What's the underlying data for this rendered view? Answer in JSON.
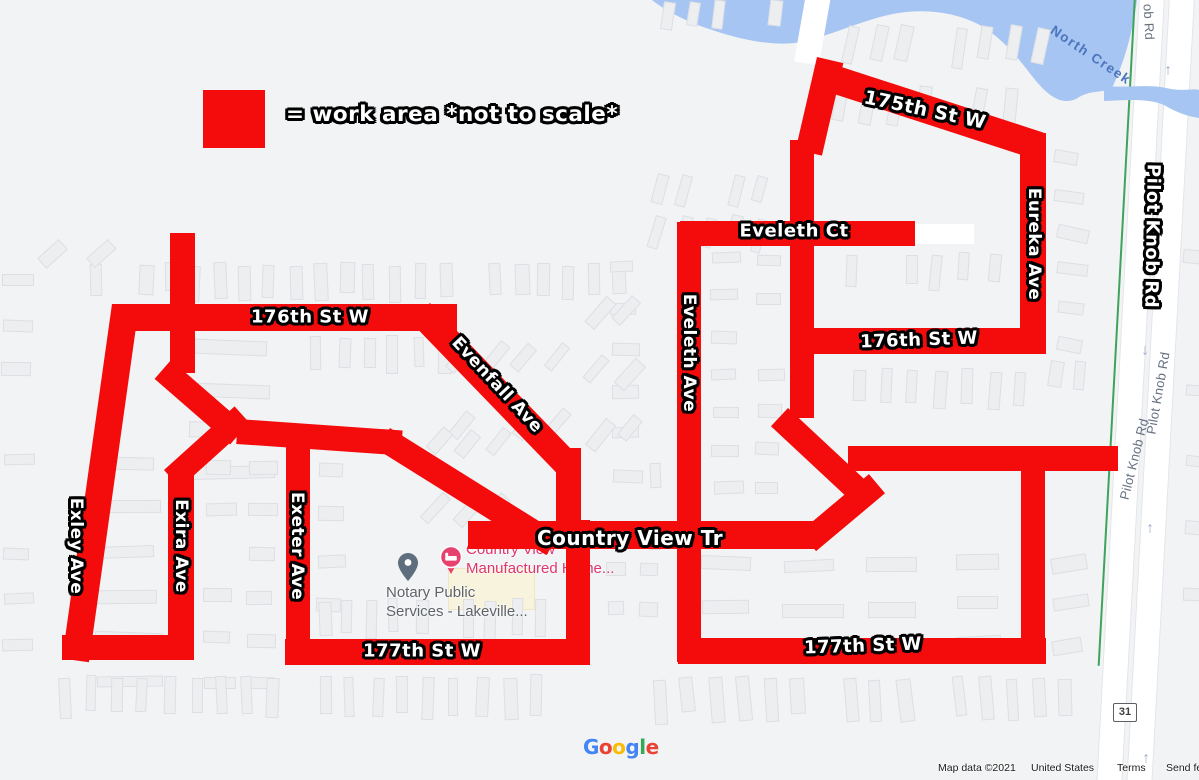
{
  "legend": {
    "swatch_color": "#f40b0b",
    "text": "= work area *not to scale*"
  },
  "colors": {
    "work_area_red": "#f40b0b",
    "map_background": "#f1f3f4",
    "water": "#a6c5f2",
    "water_label": "#4c74bd",
    "bike_route_green": "#3ea45b",
    "road_white": "#ffffff",
    "gray_road_label": "#667080",
    "poi_lodging_pink": "#e8416f",
    "poi_generic_gray": "#5f6b79",
    "arrow_blue_gray": "#9aa6c9"
  },
  "street_labels": [
    {
      "id": "175th-st-w",
      "text": "175th St W",
      "x": 925,
      "y": 110,
      "rot": 12,
      "size": 19
    },
    {
      "id": "eveleth-ct",
      "text": "Eveleth Ct",
      "x": 794,
      "y": 231,
      "rot": 0,
      "size": 18
    },
    {
      "id": "eveleth-ave",
      "text": "Eveleth Ave",
      "x": 689,
      "y": 353,
      "rot": 90,
      "size": 17
    },
    {
      "id": "176th-st-w-left",
      "text": "176th St W",
      "x": 310,
      "y": 317,
      "rot": 0,
      "size": 18
    },
    {
      "id": "evenfall-ave",
      "text": "Evenfall Ave",
      "x": 497,
      "y": 385,
      "rot": 47,
      "size": 17
    },
    {
      "id": "176th-st-w-right",
      "text": "176th St W",
      "x": 919,
      "y": 340,
      "rot": -2,
      "size": 18
    },
    {
      "id": "eureka-ave",
      "text": "Eureka Ave",
      "x": 1034,
      "y": 244,
      "rot": 90,
      "size": 17
    },
    {
      "id": "pilot-knob-rd",
      "text": "Pilot Knob Rd",
      "x": 1152,
      "y": 236,
      "rot": 91,
      "size": 18
    },
    {
      "id": "country-view-tr",
      "text": "Country View Tr",
      "x": 630,
      "y": 538,
      "rot": 0,
      "size": 20
    },
    {
      "id": "exley-ave",
      "text": "Exley Ave",
      "x": 76,
      "y": 546,
      "rot": 90,
      "size": 17
    },
    {
      "id": "exira-ave",
      "text": "Exira Ave",
      "x": 181,
      "y": 546,
      "rot": 90,
      "size": 17
    },
    {
      "id": "exeter-ave",
      "text": "Exeter Ave",
      "x": 297,
      "y": 546,
      "rot": 90,
      "size": 17
    },
    {
      "id": "177th-st-w-left",
      "text": "177th St W",
      "x": 422,
      "y": 651,
      "rot": 0,
      "size": 18
    },
    {
      "id": "177th-st-w-right",
      "text": "177th St W",
      "x": 863,
      "y": 646,
      "rot": -2,
      "size": 18
    }
  ],
  "gray_road_labels": [
    {
      "text": "Pilot Knob Rd",
      "x": 1158,
      "y": 393,
      "rot": -80
    },
    {
      "text": "Pilot Knob Rd",
      "x": 1134,
      "y": 459,
      "rot": -76
    },
    {
      "text": "ob Rd",
      "x": 1149,
      "y": 22,
      "rot": 87
    }
  ],
  "water": {
    "label": "North Creek",
    "label_x": 1091,
    "label_y": 55,
    "label_rot": 34
  },
  "work_area_segments": [
    {
      "x": 112,
      "y": 304,
      "w": 345,
      "h": 27,
      "rot": 0
    },
    {
      "x": 170,
      "y": 233,
      "w": 25,
      "h": 140,
      "rot": 0
    },
    {
      "x": 171,
      "y": 360,
      "w": 100,
      "h": 25,
      "rot": 41
    },
    {
      "x": 238,
      "y": 419,
      "w": 165,
      "h": 25,
      "rot": 4
    },
    {
      "x": 390,
      "y": 428,
      "w": 200,
      "h": 25,
      "rot": 32
    },
    {
      "x": 430,
      "y": 303,
      "w": 215,
      "h": 27,
      "rot": 46
    },
    {
      "x": 556,
      "y": 448,
      "w": 25,
      "h": 100,
      "rot": 0
    },
    {
      "x": 566,
      "y": 520,
      "w": 24,
      "h": 145,
      "rot": 0
    },
    {
      "x": 468,
      "y": 521,
      "w": 347,
      "h": 28,
      "rot": 0
    },
    {
      "x": 285,
      "y": 639,
      "w": 305,
      "h": 26,
      "rot": 0
    },
    {
      "x": 286,
      "y": 438,
      "w": 24,
      "h": 227,
      "rot": 0
    },
    {
      "x": 112,
      "y": 304,
      "w": 27,
      "h": 358,
      "rot": 8
    },
    {
      "x": 62,
      "y": 635,
      "w": 132,
      "h": 25,
      "rot": 0
    },
    {
      "x": 168,
      "y": 468,
      "w": 26,
      "h": 192,
      "rot": 0
    },
    {
      "x": 164,
      "y": 470,
      "w": 95,
      "h": 24,
      "rot": -42
    },
    {
      "x": 817,
      "y": 57,
      "w": 27,
      "h": 95,
      "rot": 13
    },
    {
      "x": 820,
      "y": 60,
      "w": 235,
      "h": 28,
      "rot": 18
    },
    {
      "x": 1020,
      "y": 133,
      "w": 26,
      "h": 221,
      "rot": 0
    },
    {
      "x": 790,
      "y": 140,
      "w": 24,
      "h": 278,
      "rot": 0
    },
    {
      "x": 788,
      "y": 408,
      "w": 105,
      "h": 25,
      "rot": 43
    },
    {
      "x": 800,
      "y": 532,
      "w": 90,
      "h": 25,
      "rot": -40
    },
    {
      "x": 848,
      "y": 446,
      "w": 270,
      "h": 25,
      "rot": 0
    },
    {
      "x": 1021,
      "y": 455,
      "w": 24,
      "h": 205,
      "rot": 0
    },
    {
      "x": 678,
      "y": 638,
      "w": 368,
      "h": 26,
      "rot": 0
    },
    {
      "x": 677,
      "y": 222,
      "w": 24,
      "h": 440,
      "rot": 0
    },
    {
      "x": 680,
      "y": 221,
      "w": 235,
      "h": 25,
      "rot": 0
    },
    {
      "x": 800,
      "y": 328,
      "w": 246,
      "h": 26,
      "rot": 0
    }
  ],
  "arrows": [
    {
      "x": 1168,
      "y": 70,
      "dir": "up"
    },
    {
      "x": 1152,
      "y": 207,
      "dir": "up"
    },
    {
      "x": 1145,
      "y": 350,
      "dir": "down"
    },
    {
      "x": 1150,
      "y": 528,
      "dir": "up"
    },
    {
      "x": 1146,
      "y": 758,
      "dir": "up"
    }
  ],
  "pois": {
    "notary": {
      "line1": "Notary Public",
      "line2": "Services - Lakeville...",
      "text_color": "#5f6368"
    },
    "country_view": {
      "line1": "Country View",
      "line2": "Manufactured Home...",
      "text_color": "#e0356d"
    }
  },
  "route_shield": {
    "number": "31"
  },
  "google_logo": {
    "letters": [
      {
        "ch": "G",
        "color": "#4285F4"
      },
      {
        "ch": "o",
        "color": "#EA4335"
      },
      {
        "ch": "o",
        "color": "#FBBC05"
      },
      {
        "ch": "g",
        "color": "#4285F4"
      },
      {
        "ch": "l",
        "color": "#34A853"
      },
      {
        "ch": "e",
        "color": "#EA4335"
      }
    ]
  },
  "attribution": {
    "map_data": "Map data ©2021",
    "region": "United States",
    "terms": "Terms",
    "feedback": "Send feedb"
  }
}
